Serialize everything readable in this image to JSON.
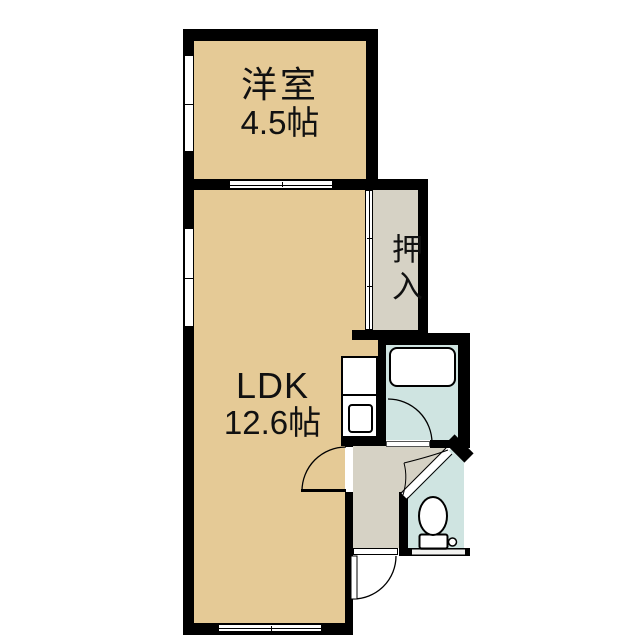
{
  "plan": {
    "type": "floor-plan",
    "rooms": {
      "western_room": {
        "label": "洋室",
        "size": "4.5帖"
      },
      "ldk": {
        "label": "LDK",
        "size": "12.6帖"
      },
      "closet": {
        "label": "押入"
      }
    },
    "fixtures": [
      "bathtub-icon",
      "toilet-icon",
      "kitchen-sink-icon",
      "door-swing-arc",
      "sliding-door",
      "window"
    ],
    "colors": {
      "room_fill": "#e5ca96",
      "hall_fill": "#d6d2c5",
      "wet_area_fill": "#cfe4e1",
      "wall": "#000000",
      "background": "#ffffff"
    }
  }
}
